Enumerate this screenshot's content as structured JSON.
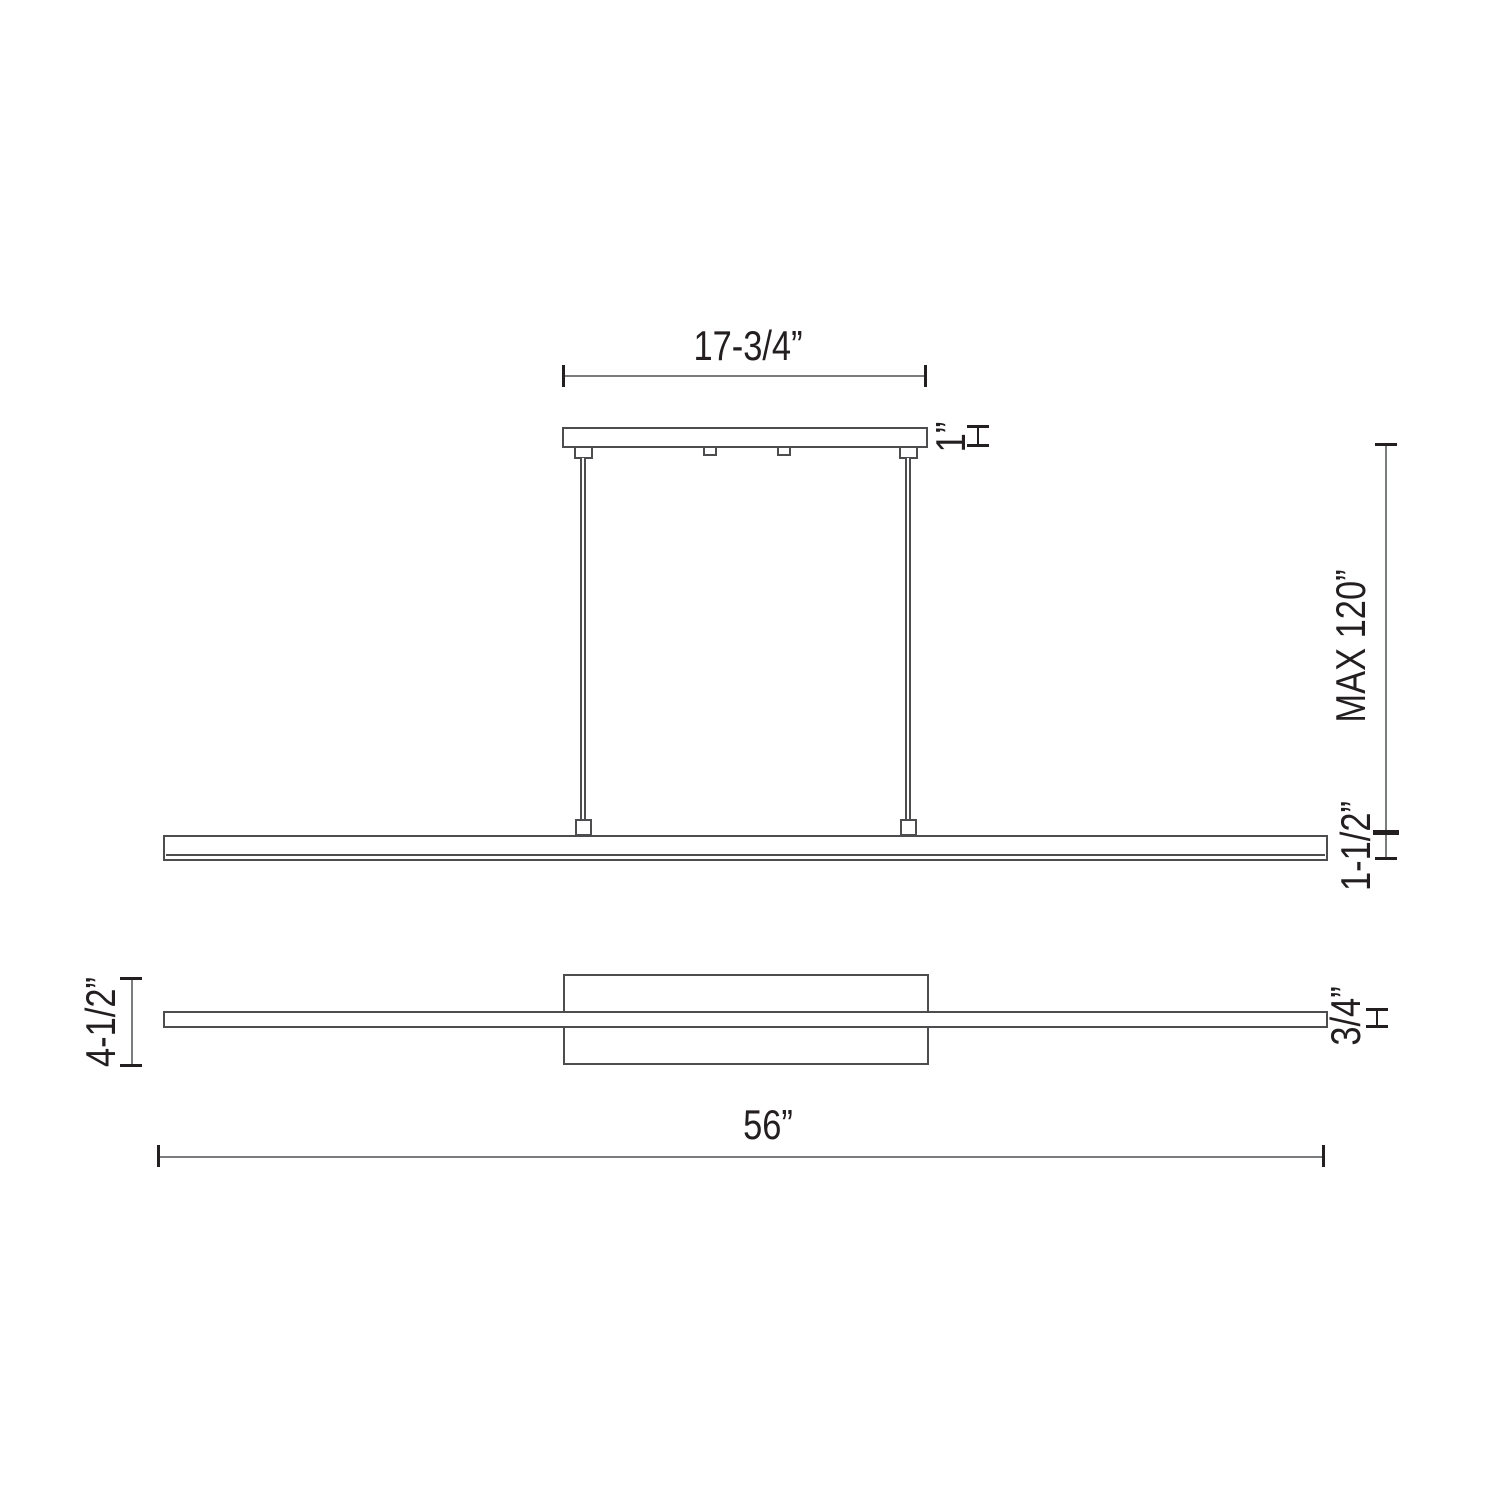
{
  "colors": {
    "background": "#ffffff",
    "outline": "#4d4d4f",
    "dim_line": "#7b7c7f",
    "ink": "#231f20"
  },
  "side_view": {
    "labels": {
      "canopy_width": "17-3/4”",
      "canopy_height": "1”",
      "suspension_max": "MAX 120”",
      "bar_height": "1-1/2”"
    }
  },
  "plan_view": {
    "labels": {
      "overall_depth": "4-1/2”",
      "bar_depth": "3/4”",
      "overall_length": "56”"
    }
  }
}
